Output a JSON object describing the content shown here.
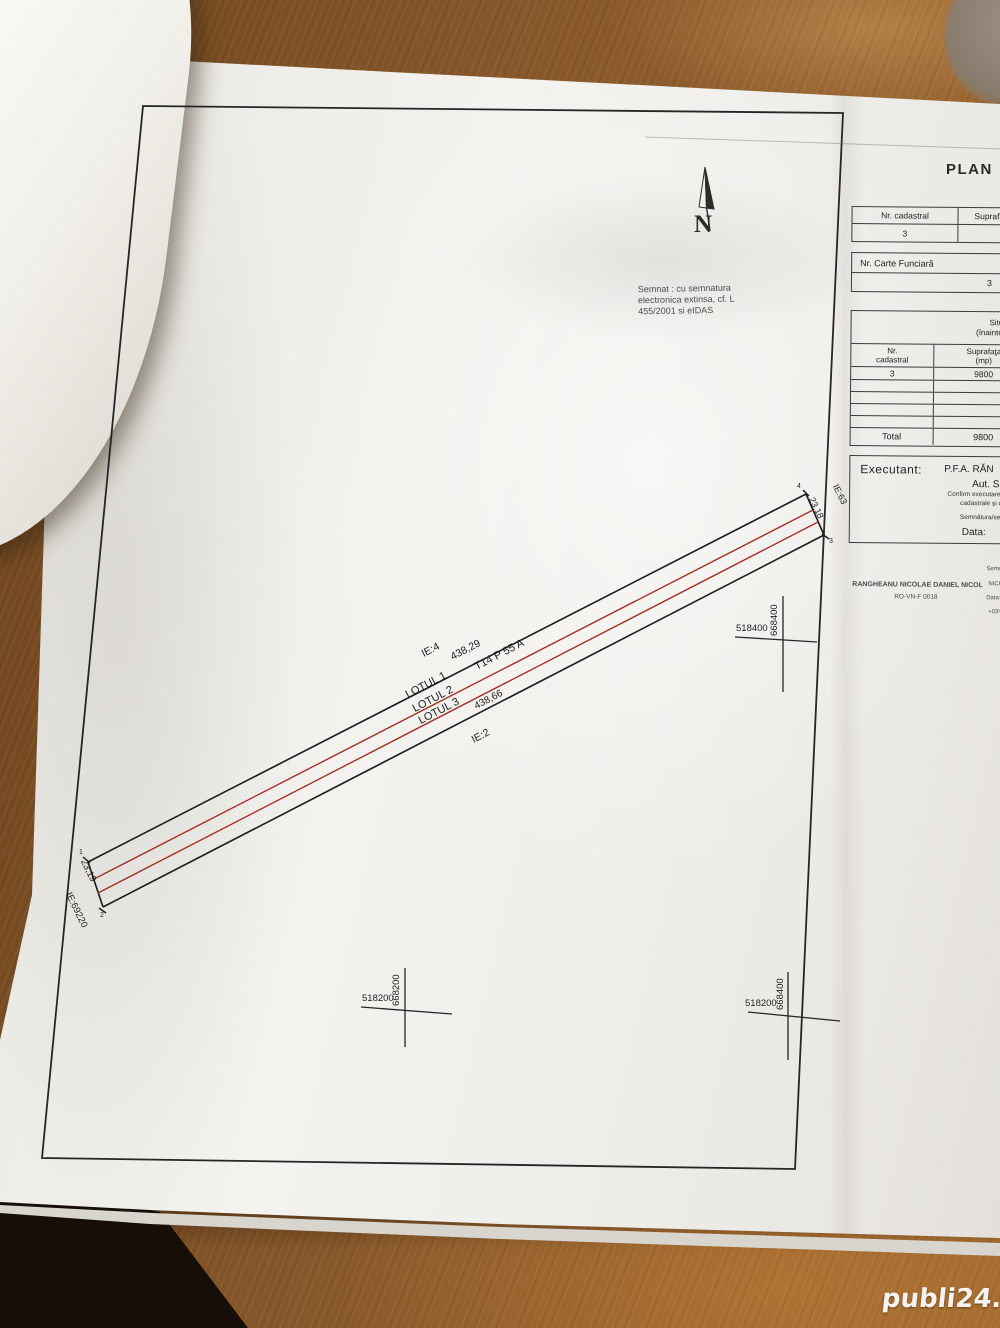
{
  "colors": {
    "wood": "#8a5a2c",
    "paper": "#efede9",
    "ink": "#222222",
    "red_line": "#a23028",
    "watermark_text": "#f5f3ef"
  },
  "watermark": {
    "text": "publi24.ro"
  },
  "plan": {
    "title_fragment": "PLAN",
    "north": {
      "label": "N"
    },
    "signature_note": {
      "line1": "Semnat : cu semnatura",
      "line2": "electronica extinsa, cf. L",
      "line3": "455/2001 si eIDAS"
    },
    "parcel": {
      "length_top": "438,29",
      "length_bottom": "438,66",
      "width_left": "23,19",
      "width_right": "23,18",
      "ie_above": "IE:4",
      "ie_below": "IE:2",
      "ie_left": "IE:69220",
      "ie_right": "IE:63",
      "tarla": "T14 P 55 A",
      "lot1": "LOTUL 1",
      "lot2": "LOTUL 2",
      "lot3": "LOTUL 3",
      "pt1": "1",
      "pt2": "2",
      "pt3": "3",
      "pt4": "4"
    },
    "crosses": [
      {
        "x_label": "518400",
        "y_label": "668400"
      },
      {
        "x_label": "518200",
        "y_label": "668200"
      },
      {
        "x_label": "518200",
        "y_label": "668400"
      }
    ],
    "title_block": {
      "table1": {
        "col1_header": "Nr. cadastral",
        "col2_header": "Suprafaț",
        "col1_value": "3"
      },
      "table2": {
        "header": "Nr. Carte Funciară",
        "value": "3"
      },
      "situatia": {
        "caption1": "Situaţi",
        "caption2": "(înainte de de",
        "col1a": "Nr.",
        "col1b": "cadastral",
        "col2a": "Suprafaţa",
        "col2b": "(mp)",
        "row_nr": "3",
        "row_mp": "9800",
        "total_label": "Total",
        "total_mp": "9800"
      },
      "executant": {
        "label": "Executant:",
        "name": "P.F.A. RĂN",
        "aut": "Aut. S",
        "confirm1": "Confirm executarea măsurătorilor la",
        "confirm2": "cadastrale şi corespondenţ",
        "confirm3": "Semnătura/semnătură digit",
        "data_label": "Data:"
      },
      "signature": {
        "name_line": "RANGHEANU NICOLAE DANIEL NICOL",
        "cert_line": "RO-VN-F 0018",
        "right1": "Semnat",
        "right2": "NICOLA",
        "right3": "Data: 2",
        "right4": "+03'0"
      }
    }
  }
}
